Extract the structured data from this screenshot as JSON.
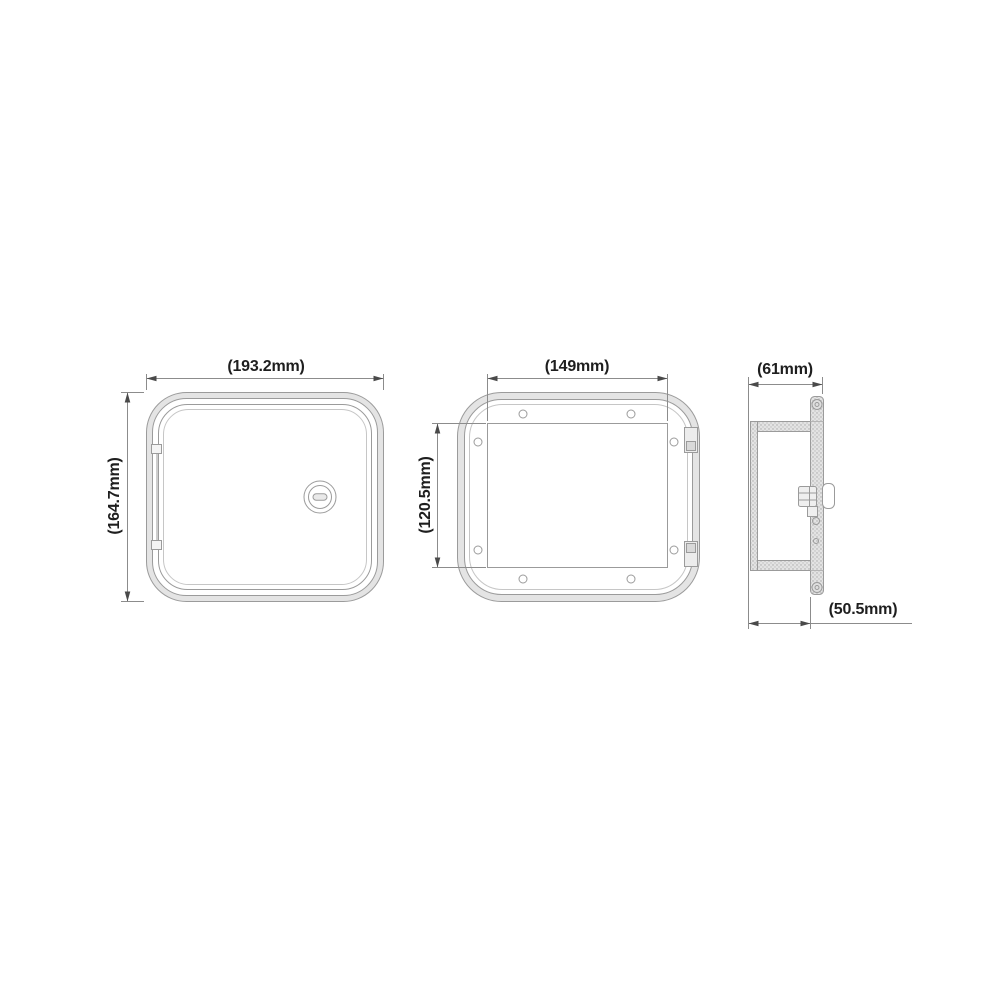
{
  "drawing": {
    "views": {
      "front": {
        "width_label": "(193.2mm)",
        "height_label": "(164.7mm)"
      },
      "back": {
        "width_label": "(149mm)",
        "height_label": "(120.5mm)"
      },
      "side": {
        "width_label": "(61mm)",
        "depth_label": "(50.5mm)"
      }
    },
    "colors": {
      "part_line": "#9b9b9b",
      "inner_line": "#c6c6c6",
      "dimension_line": "#8c8c8c",
      "arrow": "#4a4a4a",
      "label_text": "#1e1e1e",
      "band_fill": "#e4e4e4",
      "background": "#ffffff"
    }
  }
}
